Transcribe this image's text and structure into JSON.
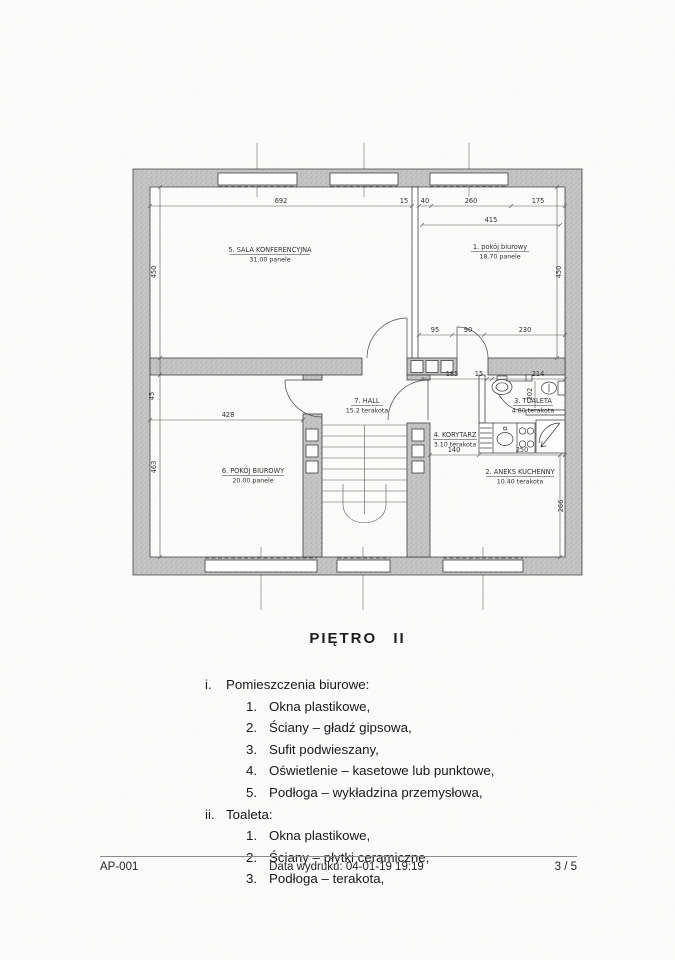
{
  "page": {
    "title": "PIĘTRO II",
    "footer": {
      "doc_id": "AP-001",
      "print_date": "Data wydruku: 04-01-19 19:19",
      "page_num": "3 / 5"
    }
  },
  "plan": {
    "rooms": [
      {
        "label": "5. SALA KONFERENCYJNA",
        "area": "31.00 panele"
      },
      {
        "label": "1. pokój biurowy",
        "area": "18.70 panele"
      },
      {
        "label": "7. HALL",
        "area": "15.2 terakota"
      },
      {
        "label": "3. TOALETA",
        "area": "4.80 terakota"
      },
      {
        "label": "4. KORYTARZ",
        "area": "3.10 terakota"
      },
      {
        "label": "6. POKÓJ BIUROWY",
        "area": "20.00 panele"
      },
      {
        "label": "2. ANEKS KUCHENNY",
        "area": "10.40 terakota"
      }
    ],
    "dims": {
      "top_sala": "692",
      "top_15": "15",
      "top_40": "40",
      "top_260": "260",
      "top_175": "175",
      "room1_width": "415",
      "left_450": "450",
      "right_450": "450",
      "r1_95": "95",
      "r1_90": "90",
      "r1_230": "230",
      "mid_185": "185",
      "mid_15": "15",
      "mid_214": "214",
      "wc_202": "202",
      "left_45": "45",
      "room6_428": "428",
      "left_463": "463",
      "kor_140": "140",
      "kit_250": "250",
      "right_266": "266"
    }
  },
  "specs": {
    "sections": [
      {
        "marker": "i.",
        "heading": "Pomieszczenia biurowe:",
        "items": [
          {
            "marker": "1.",
            "text": "Okna plastikowe,"
          },
          {
            "marker": "2.",
            "text": "Ściany – gładź gipsowa,"
          },
          {
            "marker": "3.",
            "text": "Sufit podwieszany,"
          },
          {
            "marker": "4.",
            "text": "Oświetlenie – kasetowe lub punktowe,"
          },
          {
            "marker": "5.",
            "text": "Podłoga – wykładzina przemysłowa,"
          }
        ]
      },
      {
        "marker": "ii.",
        "heading": "Toaleta:",
        "items": [
          {
            "marker": "1.",
            "text": "Okna plastikowe,"
          },
          {
            "marker": "2.",
            "text": "Ściany – płytki ceramiczne,"
          },
          {
            "marker": "3.",
            "text": "Podłoga – terakota,"
          }
        ]
      }
    ]
  }
}
